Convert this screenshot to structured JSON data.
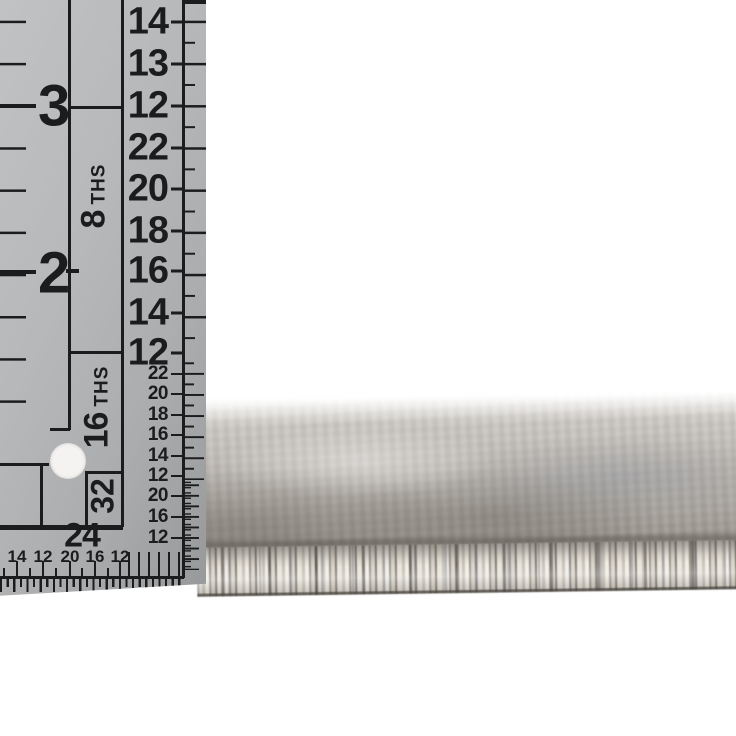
{
  "page": {
    "background_color": "#ffffff"
  },
  "ruler": {
    "body_color": "#b7b8ba",
    "marking_color": "#1b1c1e",
    "hole_color": "#f4f3f1",
    "inch_numbers": [
      "3",
      "2"
    ],
    "fourths_numbers": [
      "14",
      "13",
      "12"
    ],
    "eighths": {
      "label_number": "8",
      "label_suffix": "THS",
      "numbers": [
        "22",
        "20",
        "18",
        "16",
        "14",
        "12"
      ]
    },
    "sixteenths": {
      "label_number": "16",
      "label_suffix": "THS",
      "numbers": [
        "22",
        "20",
        "18",
        "16",
        "14",
        "12"
      ]
    },
    "thirtyseconds": {
      "label": "32",
      "numbers": [
        "20",
        "16",
        "12"
      ]
    },
    "bottom_scale": {
      "label": "24",
      "numbers": [
        "14",
        "12",
        "20",
        "16",
        "12"
      ]
    }
  },
  "rug": {
    "surface_color_light": "#cdc8c2",
    "surface_color_dark": "#8f8a82",
    "fiber_color_light": "#efece5",
    "fiber_color_dark": "#6e6a63",
    "fiber_accent_slate": "#747a86"
  }
}
